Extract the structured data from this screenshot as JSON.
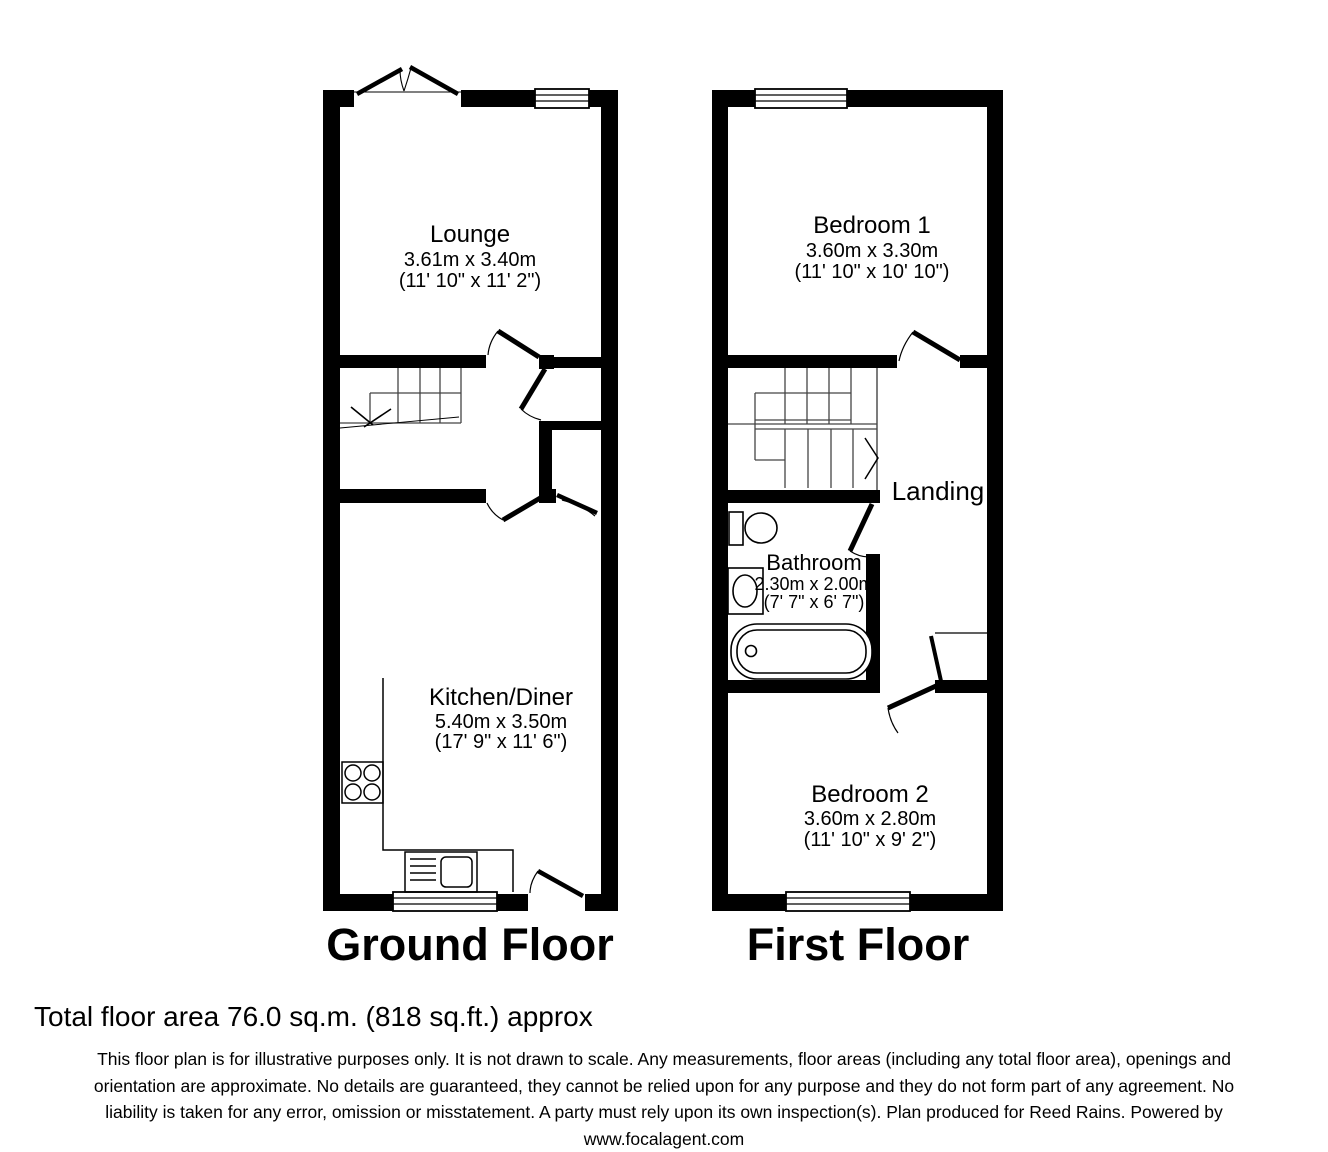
{
  "colors": {
    "wall": "#000000",
    "background": "#ffffff"
  },
  "ground_floor": {
    "title": "Ground Floor",
    "rooms": {
      "lounge": {
        "name": "Lounge",
        "metric": "3.61m x 3.40m",
        "imperial": "(11' 10\" x 11' 2\")"
      },
      "kitchen": {
        "name": "Kitchen/Diner",
        "metric": "5.40m x 3.50m",
        "imperial": "(17' 9\" x 11' 6\")"
      }
    }
  },
  "first_floor": {
    "title": "First Floor",
    "rooms": {
      "bedroom1": {
        "name": "Bedroom 1",
        "metric": "3.60m x 3.30m",
        "imperial": "(11' 10\" x 10' 10\")"
      },
      "landing": {
        "name": "Landing"
      },
      "bathroom": {
        "name": "Bathroom",
        "metric": "2.30m x 2.00m",
        "imperial": "(7' 7\" x 6' 7\")"
      },
      "bedroom2": {
        "name": "Bedroom 2",
        "metric": "3.60m x 2.80m",
        "imperial": "(11' 10\" x 9' 2\")"
      }
    }
  },
  "footer": {
    "total_area": "Total floor area 76.0 sq.m. (818 sq.ft.) approx",
    "disclaimer_lines": [
      "This floor plan is for illustrative purposes only. It is not drawn to scale. Any measurements, floor areas (including any total floor area), openings and",
      "orientation are approximate. No details are guaranteed, they cannot be relied upon for any purpose and they do not form part of any agreement. No",
      "liability is taken for any error, omission or misstatement. A party must rely upon its own inspection(s). Plan produced for Reed Rains. Powered by",
      "www.focalagent.com"
    ]
  }
}
